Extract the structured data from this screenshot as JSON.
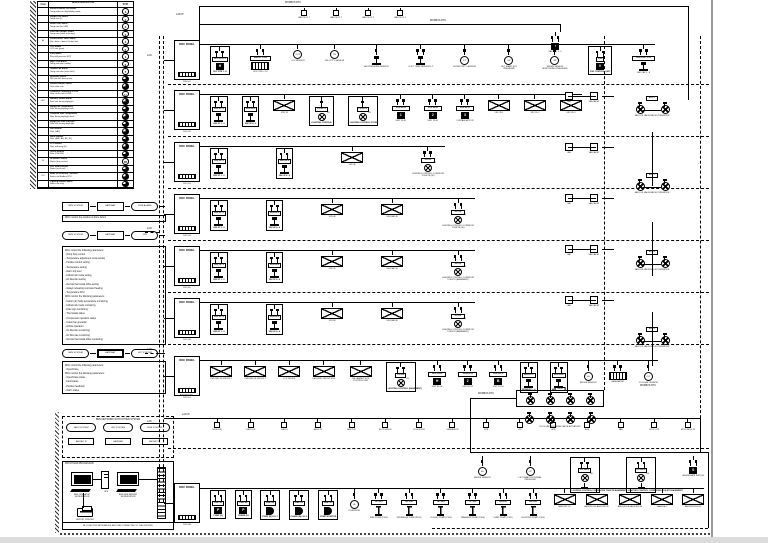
{
  "labels": {
    "lan": "LAN",
    "lan_ip": "LAN IP",
    "modbus": "MODBUS RTU",
    "bacnet": "BACNET/IP",
    "panel_title": "DDC PANEL",
    "matrix_hdr": "VAV-B",
    "matrix_lbl": "FCU & VAV MOTORIZED VALVE ACTUATORS"
  },
  "legend": {
    "headers": {
      "item": "ITEM",
      "desc": "DEVICE DESCRIPTION",
      "sym": "SYM."
    },
    "rows": [
      {
        "i": "",
        "d1": "Smoke Exhaust Fan Status",
        "d2": "Temp probe for day/holiday mode",
        "s": "1",
        "f": ""
      },
      {
        "i": "",
        "d1": "Supply Fan Status",
        "d2": "Temp rate (F)",
        "s": "2",
        "f": ""
      },
      {
        "i": "",
        "d1": "Return Fan Status",
        "d2": "Temp rate (for OFF)",
        "s": "2",
        "f": ""
      },
      {
        "i": "",
        "d1": "Fresh Air Damper Status",
        "d2": "Temp rate (value at factory)",
        "s": "3",
        "f": ""
      },
      {
        "i": "AI",
        "d1": "Chilled Water Valve Status",
        "d2": "Run alarm - above / below limit",
        "s": "4",
        "f": ""
      },
      {
        "i": "",
        "d1": "CO2 Status",
        "d2": "CO2 rate (ppm)",
        "s": "5",
        "f": ""
      },
      {
        "i": "",
        "d1": "Filter Alarm",
        "d2": "Filter diff pressure (DP)",
        "s": "1",
        "f": ""
      },
      {
        "i": "",
        "d1": "High / Low Alarm",
        "d2": "Temp rate after cooling",
        "s": "6",
        "f": ""
      },
      {
        "i": "",
        "d1": "Outdoor Air Alarm",
        "d2": "Temp rate after (extra limit)",
        "s": "7",
        "f": ""
      },
      {
        "i": "",
        "d1": "Humidity Sensor",
        "d2": "RH rate with factory limit",
        "s": "M",
        "f": "fill"
      },
      {
        "i": "",
        "d1": "Smoke Damper Status",
        "d2": "Duct static rate",
        "s": "D",
        "f": "fill"
      },
      {
        "i": "",
        "d1": "Combined Frequency of VSD",
        "d2": "Rate via the set of VSD",
        "s": "H",
        "f": ""
      },
      {
        "i": "AO",
        "d1": "Standby Smoke Alarm",
        "d2": "Duct rate during day/night",
        "s": "M",
        "f": "fill"
      },
      {
        "i": "",
        "d1": "Supply Air Temperature",
        "d2": "Rate during day/night shift",
        "s": "T",
        "f": "fill"
      },
      {
        "i": "",
        "d1": "Count Air Duct Temperature",
        "d2": "Rate during day/night level",
        "s": "P",
        "f": "fill"
      },
      {
        "i": "",
        "d1": "Supply Air Duct Pressure",
        "d2": "Rate with factory day/night",
        "s": "S",
        "f": "fill"
      },
      {
        "i": "",
        "d1": "VAV Module",
        "d2": "Rate (VAV)",
        "s": "V",
        "f": "fill"
      },
      {
        "i": "",
        "d1": "Static Module",
        "d2": "Rate (AHU, AH, BF, JU)",
        "s": "A",
        "f": "fill"
      },
      {
        "i": "",
        "d1": "LCP Module",
        "d2": "Rate with daily (O)",
        "s": "L",
        "f": "fill"
      },
      {
        "i": "",
        "d1": "On/Off Module",
        "d2": "Rate (ON/OFF)",
        "s": "O",
        "f": "fill"
      },
      {
        "i": "DI",
        "d1": "DI Module Sensor",
        "d2": "Status (dry contact)",
        "s": "DI",
        "f": ""
      },
      {
        "i": "",
        "d1": "VRV Smart Sensor",
        "d2": "Status (multi set)",
        "s": "M",
        "f": "fill"
      },
      {
        "i": "DO",
        "d1": "Meter of Generator / Breaker",
        "d2": "Status via Modbus RTU",
        "s": "G",
        "f": "fill"
      },
      {
        "i": "",
        "d1": "Lighting Module Status",
        "d2": "Status via relay",
        "s": "L",
        "f": "fill"
      }
    ]
  },
  "flows": {
    "a": [
      {
        "v": "BMS SYSTEM",
        "k": "rect"
      },
      {
        "v": "GATEWAY",
        "k": "rect"
      },
      {
        "v": "FIRE ALARM",
        "k": "pill"
      }
    ],
    "note_a": "DDC monitor the position of Zone defect",
    "b": [
      {
        "v": "BMS SYSTEM",
        "k": "pill"
      },
      {
        "v": "GATEWAY",
        "k": "rect"
      },
      {
        "v": "VRV",
        "k": "pill"
      }
    ],
    "c": [
      {
        "v": "BMS SYSTEM",
        "k": "pill"
      },
      {
        "v": "GATEWAY",
        "k": "hatchn"
      },
      {
        "v": "LIFT SYSTEM",
        "k": "pill"
      }
    ]
  },
  "notes1": {
    "lines": [
      "DDC control the following parameters:",
      "- (Run) Stop control",
      "- Temperature adjustment mode setting",
      "- Position control setting",
      "- Temperature setting",
      "- Alarm trip level",
      "- Follow lock mode setting",
      "- Air direction setting",
      "- Normal thermostat office setting",
      "- Always reheating command heating",
      "- Temperature AHU",
      "DDC monitor the following parameters:",
      "- Indoor (dry bulb) temperature monitoring",
      "- Follow lock mode monitoring",
      "- Filter sign monitoring",
      "- Thermostat status",
      "- Compressor operation status",
      "- Indoor fan operation",
      "- Airflow operation",
      "- Air direction monitoring",
      "- Air flow rate monitoring",
      "- Normal thermostat office monitoring"
    ]
  },
  "notes2": {
    "lines": [
      "DDC control the following parameters:",
      "- Open/Close",
      "DDC monitor the following parameters:",
      "- Open/Close status",
      "- Fault status",
      "- Position feedback",
      "- Alarm status"
    ]
  },
  "network_box": {
    "title": "BMS NETWORK WITH OTHER SYSTEM",
    "systems": [
      {
        "v": "AHU SYSTEM"
      },
      {
        "v": "VRV SYSTEM"
      },
      {
        "v": "FIRE SYSTEM"
      }
    ],
    "links": [
      {
        "v": "BACNET IP"
      },
      {
        "v": "GATEWAY"
      },
      {
        "v": "BACNET IP"
      }
    ]
  },
  "workstation": {
    "title": "FRONT END PROCESSOR",
    "left": "BMS OPERATOR WORKSTATION",
    "ups": "UPS",
    "right": "BMS WEB SERVER WORKSTATION",
    "printer": "REPORT PRINTER",
    "caption": "ALL ELECTRIC APPLIANCES MUST BE CONNECTED TO THE GROUND"
  },
  "top_devices": [
    {
      "l": "VAV PILOT 1"
    },
    {
      "l": "VAV PILOT 2"
    },
    {
      "l": "VAV PILOT 3"
    },
    {
      "l": "VAV PILOT 4"
    }
  ],
  "top_right": [
    {
      "t": "f2 blk",
      "g": "V",
      "l": "VAV-CAV 1...2"
    }
  ],
  "rows": {
    "r1": {
      "sub": "DDC-01",
      "devices": [
        {
          "t": "f2 hdr blk",
          "h": "RLY-PCB-1",
          "g": "H",
          "l": "RLY PCB 1...8"
        },
        {
          "t": "f4 hdrw mach",
          "h": "RELAY PCB",
          "l": "RLY PCB 1...16"
        },
        {
          "t": "circ",
          "c": "CO2",
          "l": "CO2 SENSOR"
        },
        {
          "t": "circ",
          "c": "VS",
          "l": "VELOCITY SENSOR"
        },
        {
          "t": "f1 ped",
          "l": "AIR PRESSURE SENSOR"
        },
        {
          "t": "f2 ped",
          "l": "DUCT TEMP SENSOR 1-2"
        },
        {
          "t": "f1 circ",
          "c": "FT",
          "l": "FILTER DIRTY SENSOR"
        },
        {
          "t": "f1 circ",
          "c": "DP",
          "l": "LIFT SHAFT EXT PRESSURE"
        },
        {
          "t": "f1 circ",
          "c": "SP",
          "l": "SMOKE SENSOR MONITORING PRESSURE"
        },
        {
          "t": "f2 hdr blk",
          "h": "VSD",
          "g": "V",
          "l": "VSD CONTROL UNIT"
        },
        {
          "t": "f2 hdrw ped",
          "h": "VAV-CAV 1...8",
          "l": "VAV CAV 1...8"
        }
      ]
    },
    "r2": {
      "sub": "DDC-02",
      "devices": [
        {
          "t": "f2 hdr ped",
          "h": "VAV-2F-1",
          "l": "VAV 2F 1...3"
        },
        {
          "t": "f2 hdr ped",
          "h": "VAV-2F-2",
          "l": "VAV 2F 4...6"
        },
        {
          "t": "env",
          "l": "VRV 2F"
        },
        {
          "t": "f1 hdr light",
          "h": "LC-2F-1",
          "x": "LN",
          "l": "LIGHTING CONTROL"
        },
        {
          "t": "f1 hdr light",
          "h": "LC-2F-2",
          "x": "LN",
          "l": "LIGHTING CONTROL FOYER"
        },
        {
          "t": "f2 hdrw blk",
          "h": "VAV-2F-A",
          "g": "1",
          "l": "UNIT 2F-01"
        },
        {
          "t": "f2 hdrw blk",
          "h": "VAV-2F-B",
          "g": "2",
          "l": "UNIT 2F-02"
        },
        {
          "t": "f2 hdrw blk",
          "h": "VAV-2F-C",
          "g": "3",
          "l": "CURTAIN MOTOR"
        },
        {
          "t": "env",
          "l": "VRV 2F-1"
        },
        {
          "t": "env",
          "l": "VRV 2F-2"
        },
        {
          "t": "env",
          "l": "VRV 2F-3"
        }
      ]
    },
    "r3": {
      "sub": "DDC-03",
      "devices": [
        {
          "t": "f2 hdr ped",
          "h": "VAV-3F-1",
          "l": "VAV 3F 1...3"
        },
        {
          "t": "f2 hdr ped",
          "h": "VAV-3F-2",
          "l": "VAV 3F 4...6"
        },
        {
          "t": "env",
          "l": "VRV 3F"
        },
        {
          "t": "f2 hdrw light lightw",
          "h": "LC-3F",
          "x": "LN",
          "l": "LIGHTING CONTROL CORRIDOR TOILETS (3F)"
        }
      ]
    },
    "r4": {
      "sub": "DDC-04",
      "devices": [
        {
          "t": "f2 hdr ped",
          "h": "VAV-4F-1",
          "l": "VAV 4F 1...3"
        },
        {
          "t": "f2 hdr ped",
          "h": "VAV-4F-2",
          "l": "VAV 4F 4...6"
        },
        {
          "t": "env",
          "l": "VRV 4F"
        },
        {
          "t": "env",
          "l": "VRV/VAV 4F"
        },
        {
          "t": "f2 hdrw light lightw",
          "h": "LC-4F",
          "x": "LN",
          "l": "LIGHTING CONTROL CORRIDOR TOILETS (4F)"
        }
      ]
    },
    "r5": {
      "sub": "DDC-05",
      "devices": [
        {
          "t": "f2 hdr ped",
          "h": "VAV-5F-1",
          "l": "VAV 5F 1...3"
        },
        {
          "t": "f2 hdr ped",
          "h": "VAV-5F-2",
          "l": "VAV 5F 4...6"
        },
        {
          "t": "env",
          "l": "VRV 5F"
        },
        {
          "t": "env",
          "l": "VRV/VAV 5F"
        },
        {
          "t": "f2 hdrw light lightw",
          "h": "LC-5F",
          "x": "LN",
          "l": "LIGHTING CONTROL CORRIDOR TOILETS (BASEMENT)"
        }
      ]
    },
    "r6": {
      "sub": "DDC-06",
      "devices": [
        {
          "t": "f2 hdr ped",
          "h": "VAV-6F-1",
          "l": "VAV 6F 1...3"
        },
        {
          "t": "f2 hdr ped",
          "h": "VAV-6F-2",
          "l": "VAV 6F 4...6"
        },
        {
          "t": "env",
          "l": "VRV 6F"
        },
        {
          "t": "env",
          "l": "VRV/VAV 6F"
        },
        {
          "t": "f2 hdrw light lightw",
          "h": "LC-6F",
          "x": "LN",
          "l": "LIGHTING CONTROL CORRIDOR TOILETS (BASEMENT)"
        }
      ]
    },
    "r8": {
      "sub": "DDC-07",
      "devices": [
        {
          "t": "env",
          "l": "CHILLER-1F GROUP 1"
        },
        {
          "t": "env",
          "l": "CHILLER-2F GROUP 2"
        },
        {
          "t": "env",
          "l": "LCP GROUP"
        },
        {
          "t": "env",
          "l": "DELIVERY GROUP B1-F"
        },
        {
          "t": "env",
          "l": "PA CABINET ECS CONTROL UNIT"
        },
        {
          "t": "f2 hdr light",
          "h": "LC-B1",
          "x": "LN",
          "l": "LIGHTING CONTROL (BASEMENT)"
        },
        {
          "t": "f4 hdrw blk",
          "h": "VAV-B1-A",
          "g": "H",
          "l": "UNIT B1-01"
        },
        {
          "t": "f4 hdrw blk",
          "h": "VAV-B1-B",
          "g": "2",
          "l": "UNIT B1-02"
        },
        {
          "t": "f4 hdrw blk",
          "h": "VAV-B1-C",
          "g": "B",
          "l": "UNIT B1-03"
        },
        {
          "t": "f2 hdr ped",
          "h": "VAV-B1-1",
          "l": "MODBUS 1...4"
        },
        {
          "t": "f2 hdr ped",
          "h": "VAV-B1-2",
          "l": "MODBUS 5...8"
        },
        {
          "t": "f1 circ",
          "c": "SS",
          "l": "SMOKE SENSOR"
        },
        {
          "t": "f2 mach",
          "l": "GENERATOR"
        },
        {
          "t": "f1 circ",
          "c": "CO",
          "l": "CO LEVEL SENSOR"
        }
      ]
    },
    "rb": {
      "sub": "DDC-08",
      "devices": [
        {
          "t": "f2 hdr blk",
          "h": "PMP-01",
          "g": "P",
          "l": "PUMP (U)"
        },
        {
          "t": "f2 hdr blk",
          "h": "PMP-02",
          "g": "P",
          "l": "PHASE (U)"
        },
        {
          "t": "f2 hdr dsh",
          "h": "PMP-03",
          "l": "PUMP (B) LVL-1"
        },
        {
          "t": "f2 hdr dsh",
          "h": "PMP-04",
          "l": "PHASE (B) LVL-2"
        },
        {
          "t": "f2 hdr dsh",
          "h": "PMP-05",
          "l": "PUMP MONITOR"
        },
        {
          "t": "f1 circ",
          "c": "LS",
          "l": "LS SENSOR"
        },
        {
          "t": "f2 hdrw pipe",
          "h": "FP-101",
          "l": "FIRE PUMP (P101)"
        },
        {
          "t": "f2 hdrw pipe",
          "h": "SP-102",
          "l": "SPRINKLER PUMP (P102)"
        },
        {
          "t": "f2 hdrw pipe",
          "h": "JP-103",
          "l": "JOCKEY PUMP (P103)"
        },
        {
          "t": "f2 hdrw pipe",
          "h": "TP-104",
          "l": "TRANSFER PUMP (P104)"
        },
        {
          "t": "f2 hdrw pipe",
          "h": "SU-105",
          "l": "SUMP PUMP (P105)"
        },
        {
          "t": "f2 hdrw pipe",
          "h": "BP-106",
          "l": "BOOSTER PUMP (P106)"
        },
        {
          "t": "env",
          "l": "AHU/VRV 1F"
        },
        {
          "t": "env",
          "l": "AHU/VRV-1F AHU/VRV-2F"
        },
        {
          "t": "env",
          "l": "AHU/VRV-3F AHU/VRV-4F"
        },
        {
          "t": "env",
          "l": "DAIKIN A.C"
        },
        {
          "t": "env",
          "l": "AHU/VRV/FCU B"
        }
      ]
    },
    "sub": {
      "devices": [
        {
          "t": "f1 circ",
          "c": "SS",
          "l": "SMOKE SENSOR"
        },
        {
          "t": "f1 circ",
          "c": "LP",
          "l": "LIFT SHAFT EXTERNAL PRESSURE"
        },
        {
          "t": "f2 hdr lamp",
          "h": "LC-B2-1",
          "x": "LN",
          "l": "LIGHTING CONTROL CORRIDORS TOILETS BASEMENT"
        },
        {
          "t": "f2 hdr lamp",
          "h": "LC-B2-2",
          "x": "LN",
          "l": "LIGHTING CONTROL CORRIDORS TOILETS BASEMENT"
        },
        {
          "t": "f2 blk",
          "g": "S",
          "l": "AGGREGATE SWITCH"
        }
      ]
    }
  },
  "bus_row": {
    "label": "LAN IP",
    "items": [
      {
        "l": "CHLR-1-2F"
      },
      {
        "l": "CHLR-2-2F"
      },
      {
        "l": "CHLR-3"
      },
      {
        "l": "AHU-1-2F"
      },
      {
        "l": "AHU-2-2F"
      },
      {
        "l": "MCCP-VRV-2F"
      },
      {
        "l": "COLD ROOM"
      },
      {
        "l": "GENERATOR"
      },
      {
        "l": "WTR"
      },
      {
        "l": "LTS"
      },
      {
        "l": "ACB"
      },
      {
        "l": "AOB"
      },
      {
        "l": "FAN"
      },
      {
        "l": "MCCP-1-2F"
      },
      {
        "l": "MCCP-BLDG-2F"
      }
    ]
  },
  "right_pairs": [
    {
      "a": "VAV",
      "b": "VAV-CAV-HT"
    },
    {
      "a": "VAV",
      "b": "VAV-CAV-HT"
    },
    {
      "a": "VAV",
      "b": "VAV-CAV-HT"
    },
    {
      "a": "VAV",
      "b": "VAV-CAV-HT"
    },
    {
      "a": "VAV",
      "b": "VAV-CAV-HT"
    }
  ],
  "right_clusters": [
    {
      "h": "AHU-1",
      "l": "FAN COIL VALVE/VAV MOTORIZATION"
    },
    {
      "h": "AHU-2",
      "l": "FAN COIL VALVE/VAV MOTORIZATION"
    },
    {
      "h": "AHU-3",
      "l": "FAN COIL VALVE/VAV MOTORIZATION"
    },
    {
      "h": "AHU-4",
      "l": "FAN COIL VALVE/VAV MOTORIZATION"
    }
  ],
  "matrix": {
    "row1": [
      {},
      {},
      {},
      {}
    ],
    "row2": [
      {},
      {},
      {},
      {}
    ]
  }
}
